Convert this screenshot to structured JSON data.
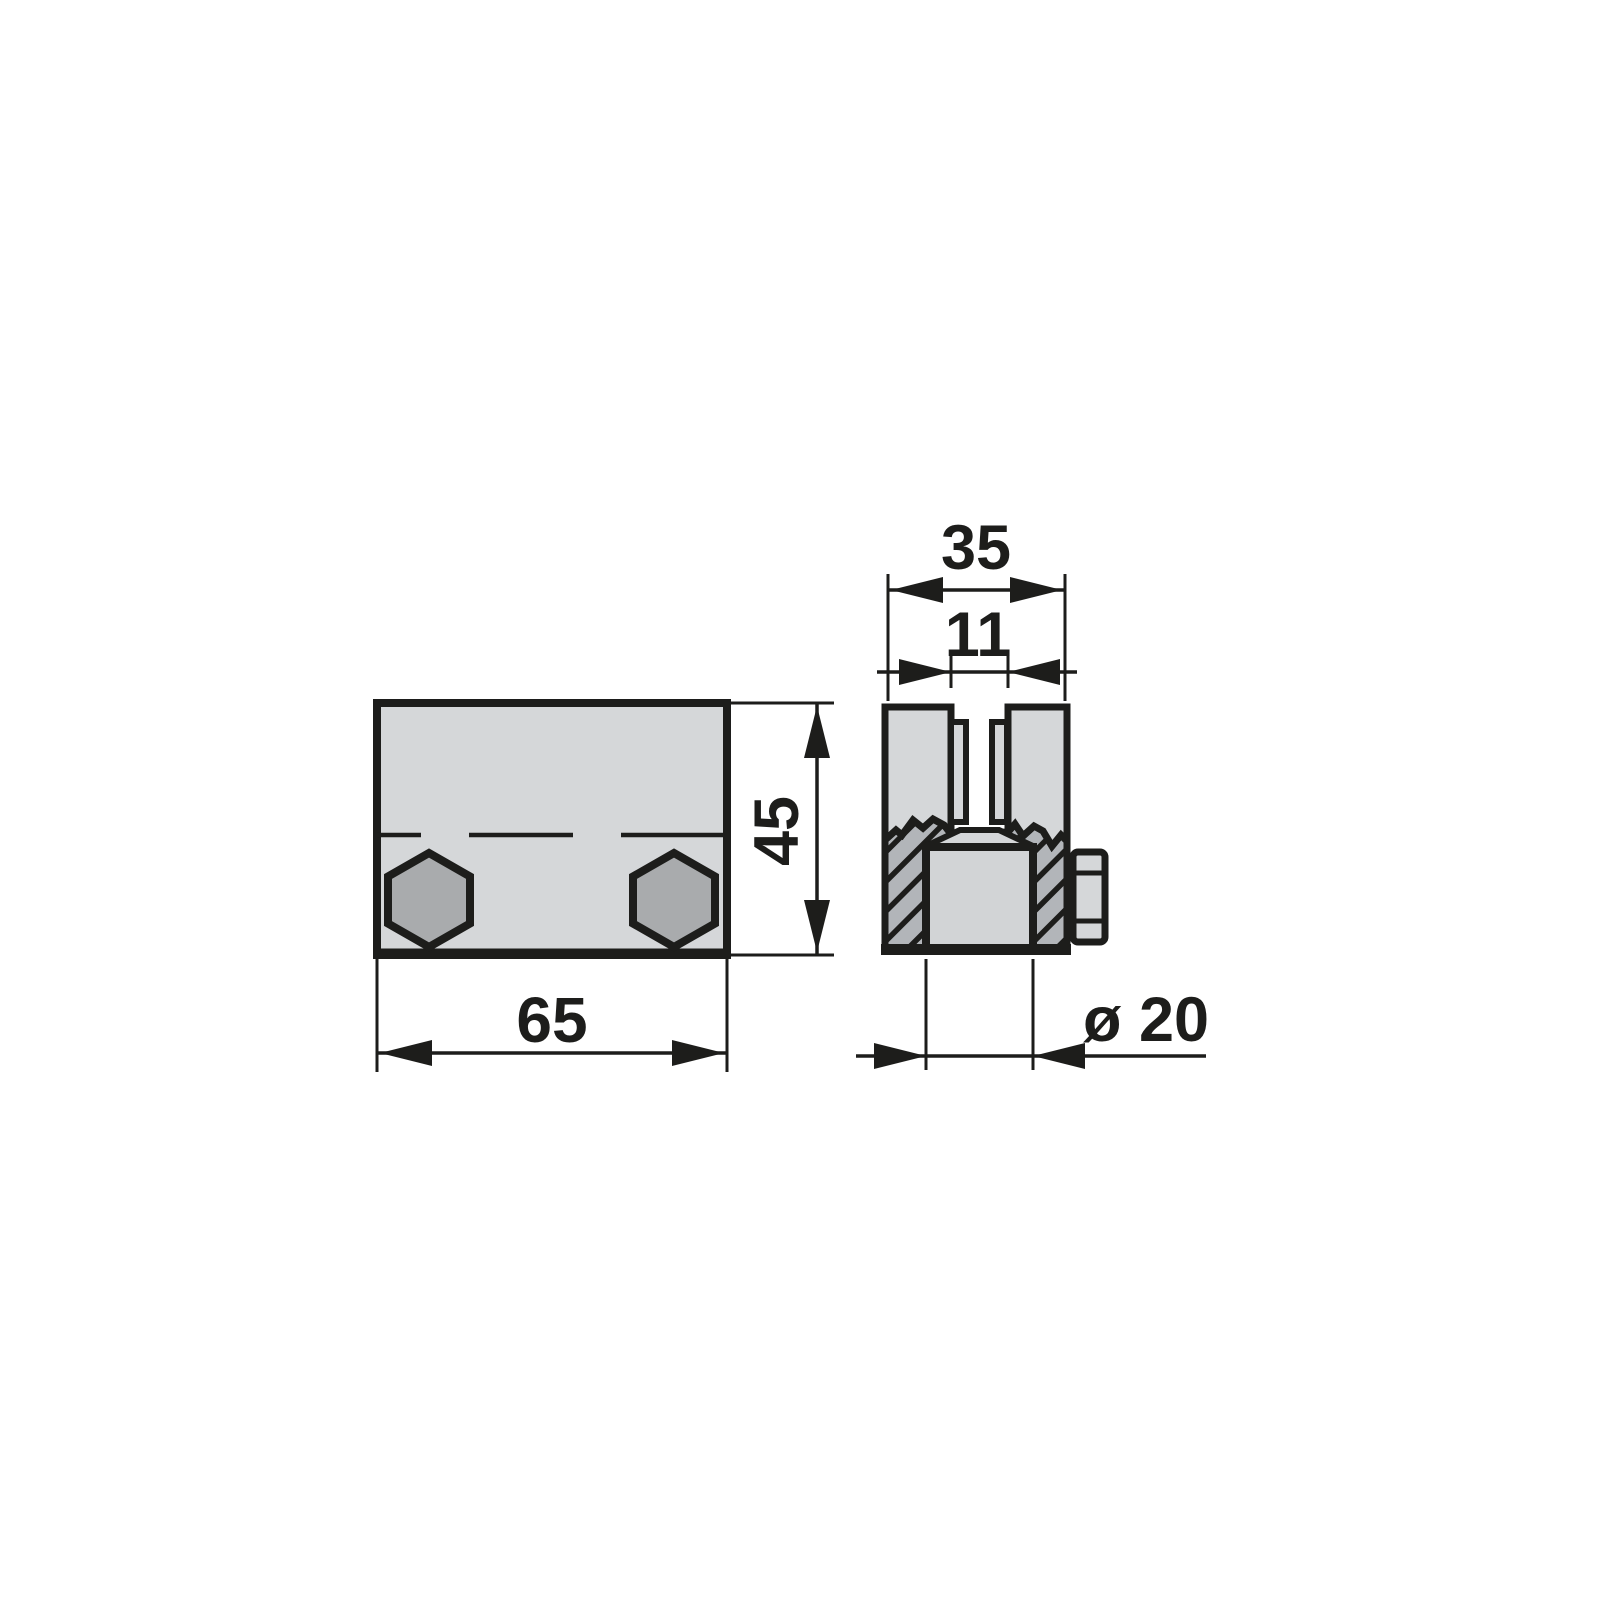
{
  "dimensions": {
    "front_width": "65",
    "front_height": "45",
    "side_width": "35",
    "side_slot_width": "11",
    "side_pin_diameter": "ø 20"
  },
  "colors": {
    "ink": "#1d1d1b",
    "canvas-bg": "#ffffff",
    "part-fill": "#d5d7d9",
    "pin-fill": "#d2d4d6",
    "hex-fill": "#a9abad",
    "hatch-bg": "#b2b5b9"
  }
}
